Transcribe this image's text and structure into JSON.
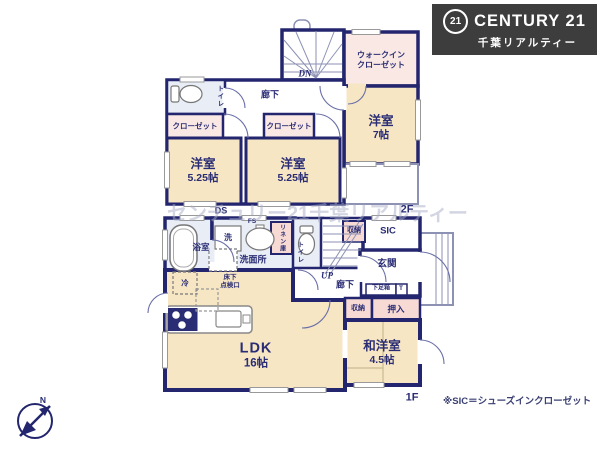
{
  "colors": {
    "wall_navy": "#23266e",
    "room_floor_cream": "#f6e6c4",
    "closet_pink": "#f8dad4",
    "wet_area_blue": "#e9eef6",
    "logo_background": "#3d3d3d"
  },
  "logo": {
    "badge": "21",
    "brand": "CENTURY 21",
    "company": "千葉リアルティー"
  },
  "watermark": "センチュリー21千葉リアルティー",
  "floor2": {
    "label": "2F",
    "stairs_label": "DN",
    "duct_label": "DS",
    "rooms": {
      "wic": "ウォークイン\nクローゼット",
      "bedroom7": {
        "name": "洋室",
        "size": "7帖"
      },
      "toilet": "トイレ",
      "hallway": "廊下",
      "closet_left": "クローゼット",
      "closet_right": "クローゼット",
      "bedroom_left": {
        "name": "洋室",
        "size": "5.25帖"
      },
      "bedroom_right": {
        "name": "洋室",
        "size": "5.25帖"
      }
    }
  },
  "floor1": {
    "label": "1F",
    "stairs_label": "UP",
    "rooms": {
      "bath": "浴室",
      "washer": "洗",
      "washroom": "洗面所",
      "linen": "リネン庫",
      "pipe_space": "FS",
      "floor_hatch": "床下\n点検口",
      "fridge": "冷",
      "toilet": "トイレ",
      "hallway": "廊下",
      "storage_top": "収納",
      "sic": "SIC",
      "entrance": "玄関",
      "shoe_box": "下足箱",
      "shoe_box_t": "T",
      "storage_bottom": "収納",
      "oshiire": "押入",
      "ldk": {
        "name": "LDK",
        "size": "16帖"
      },
      "washitsu": {
        "name": "和洋室",
        "size": "4.5帖"
      }
    }
  },
  "note": "※SIC＝シューズインクローゼット",
  "compass": {
    "north": "N"
  }
}
